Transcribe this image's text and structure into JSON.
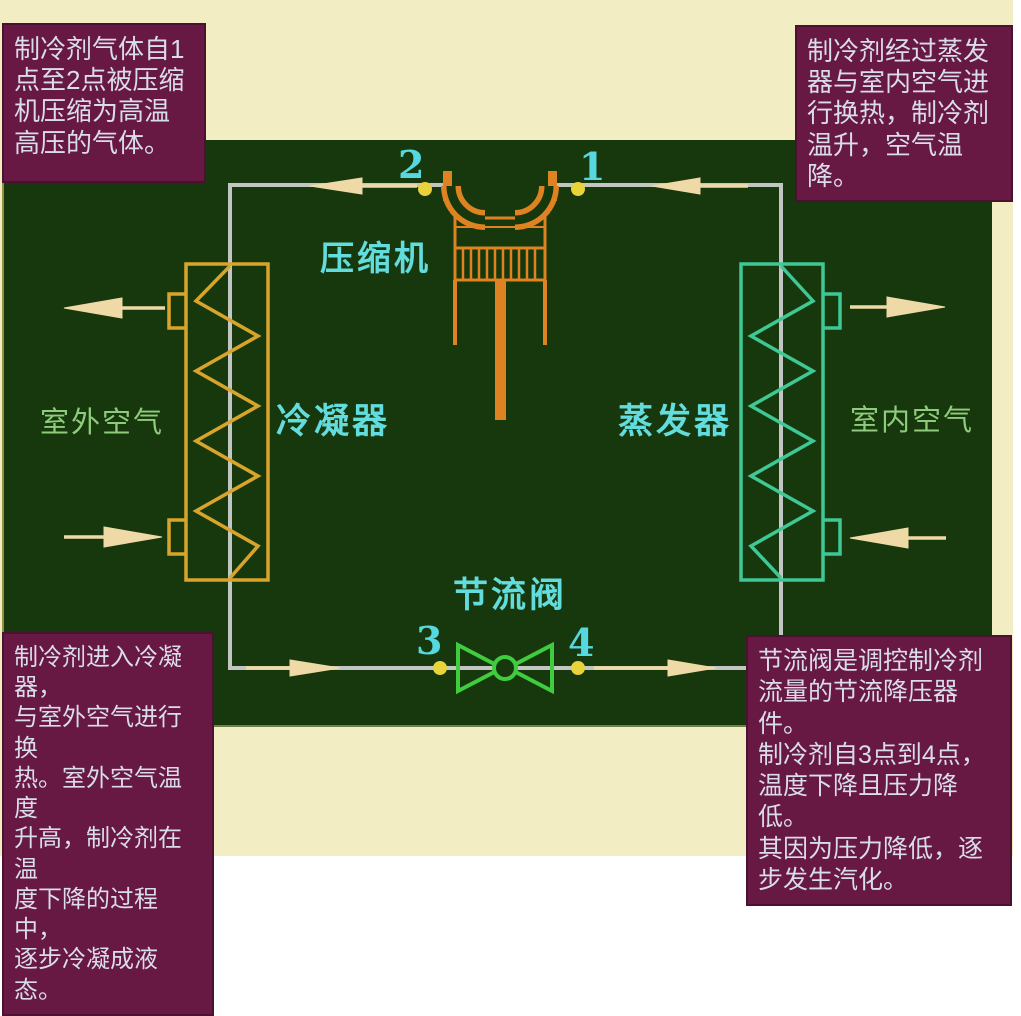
{
  "notes": {
    "top_left": "制冷剂气体自1\n点至2点被压缩\n机压缩为高温\n高压的气体。",
    "top_right": "制冷剂经过蒸发\n器与室内空气进\n行换热，制冷剂\n温升，空气温降。",
    "bottom_left": "制冷剂进入冷凝器，\n与室外空气进行换\n热。室外空气温度\n升高，制冷剂在温\n度下降的过程中，\n逐步冷凝成液态。",
    "bottom_right": "节流阀是调控制冷剂\n流量的节流降压器件。\n制冷剂自3点到4点，\n温度下降且压力降低。\n其因为压力降低，逐\n步发生汽化。"
  },
  "diagram": {
    "components": {
      "compressor": "压缩机",
      "condenser": "冷凝器",
      "evaporator": "蒸发器",
      "throttle_valve": "节流阀"
    },
    "air_labels": {
      "outdoor": "室外空气",
      "indoor": "室内空气"
    },
    "points": {
      "p1": "1",
      "p2": "2",
      "p3": "3",
      "p4": "4"
    }
  },
  "colors": {
    "background_cream": "#F3EDC3",
    "panel_green": "#17380C",
    "note_maroon": "#671843",
    "note_text": "#D9DCEA",
    "cyan_label": "#62DCDC",
    "air_label_green": "#8FCB7C",
    "compressor_orange": "#DE8222",
    "condenser_gold": "#D8A42C",
    "evaporator_teal": "#3FC896",
    "valve_green": "#3FCC3F",
    "pipe_gray": "#C2C6C2",
    "arrow_wheat": "#EFD9A6",
    "dot_yellow": "#E8D33B"
  }
}
